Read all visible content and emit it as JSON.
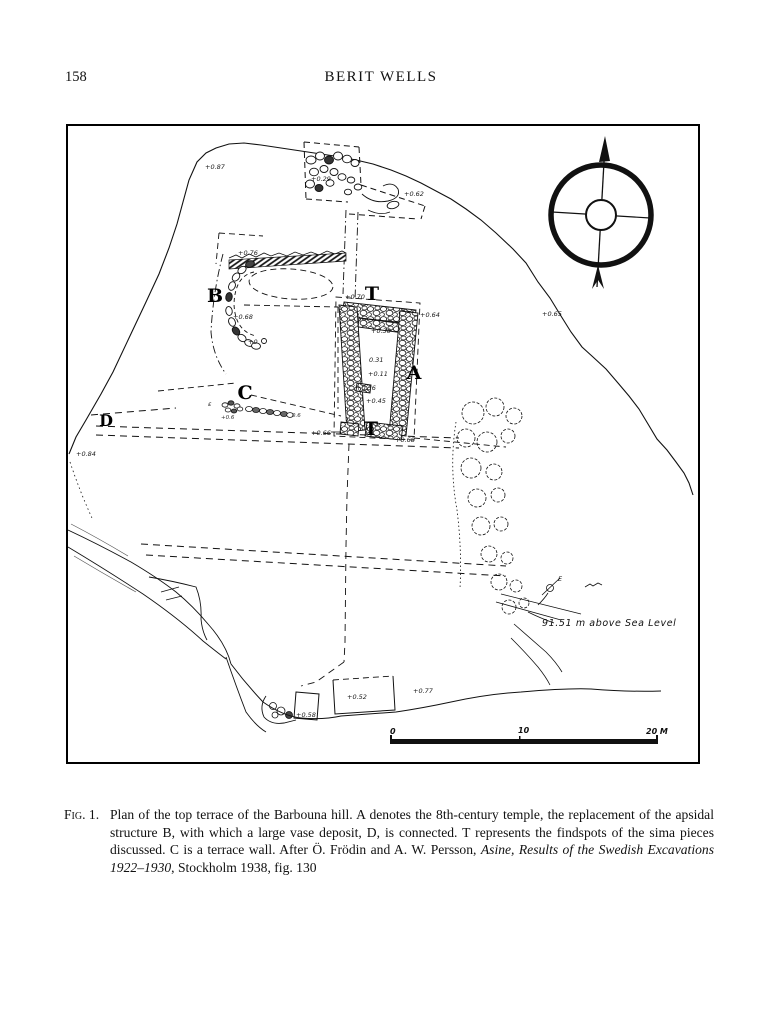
{
  "page": {
    "number": "158",
    "running_head": "BERIT WELLS"
  },
  "figure": {
    "caption": {
      "label": "Fig. 1.",
      "body_roman_1": "Plan of the top terrace of the Barbouna hill. A denotes the 8th-century temple, the replacement of the apsidal structure B, with which a large vase deposit, D, is connected. T represents the findspots of the sima pieces discussed. C is a terrace wall. After Ö. Frödin and A. W. Persson, ",
      "body_italic": "Asine, Results of the Swedish Excavations 1922–1930",
      "body_roman_2": ", Stockholm 1938, fig. 130"
    },
    "map": {
      "structure_labels": {
        "temple": "A",
        "apsidal": "B",
        "terrace_wall": "C",
        "deposit": "D",
        "findspot": "T"
      },
      "elevations": {
        "hill_nw": "+0.87",
        "top_stones": "+0.29",
        "ne_slope": "+0.62",
        "east_slope": "+0.65",
        "apsidal_north": "+0.76",
        "apsidal_mid": "+0.68",
        "apsidal_south": "+0",
        "temple_nw": "+0.70",
        "temple_ne": "+0.64",
        "temple_crosswall": "+0.30",
        "temple_cella_1": "0.31",
        "temple_cella_2": "+0.11",
        "temple_cella_3": "+0.36",
        "temple_cella_4": "+0.45",
        "temple_sw": "+0.66",
        "temple_se": "+0.68",
        "west_edge": "+0.84",
        "south_structure_small": "+0.58",
        "south_structure_large": "+0.52",
        "south_slope": "+0.77",
        "terrace_wall_west": "+0.6",
        "terrace_wall_east": "0.6"
      },
      "annotations": {
        "sea_level": "91.51 m above Sea Level",
        "epsilon": "ε",
        "point_e": "E"
      },
      "scale_bar": {
        "zero": "0",
        "ten": "10",
        "twenty": "20 M"
      }
    }
  }
}
